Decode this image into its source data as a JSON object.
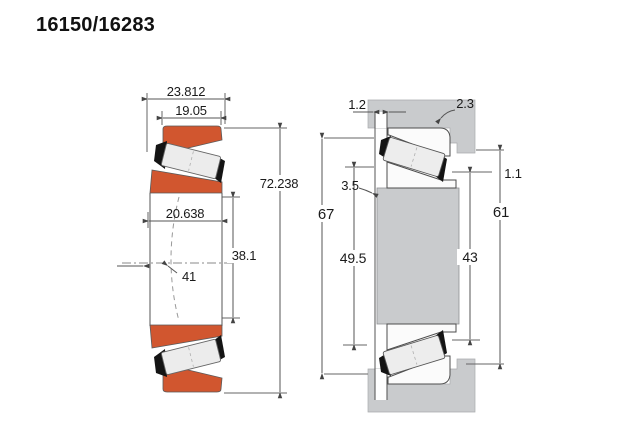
{
  "title": "16150/16283",
  "left_figure": {
    "label": "bearing cross-section",
    "dims": {
      "total_width": "23.812",
      "cup_width": "19.05",
      "outer_diameter": "72.238",
      "cone_width": "20.638",
      "bore_diameter": "38.1",
      "raceway_label": "41"
    }
  },
  "right_figure": {
    "label": "mounting dimensions",
    "dims": {
      "shaft_fillet": "1.2",
      "housing_fillet": "2.3",
      "shoulder_fillet": "3.5",
      "left_outer_diameter": "67",
      "shaft_abutment_diameter": "49.5",
      "housing_step": "1.1",
      "housing_abutment_diameter": "61",
      "cone_backface_diameter": "43"
    }
  },
  "colors": {
    "ring_orange": "#d1562f",
    "steel_gray": "#c9cbcd",
    "cage_black": "#141414"
  }
}
